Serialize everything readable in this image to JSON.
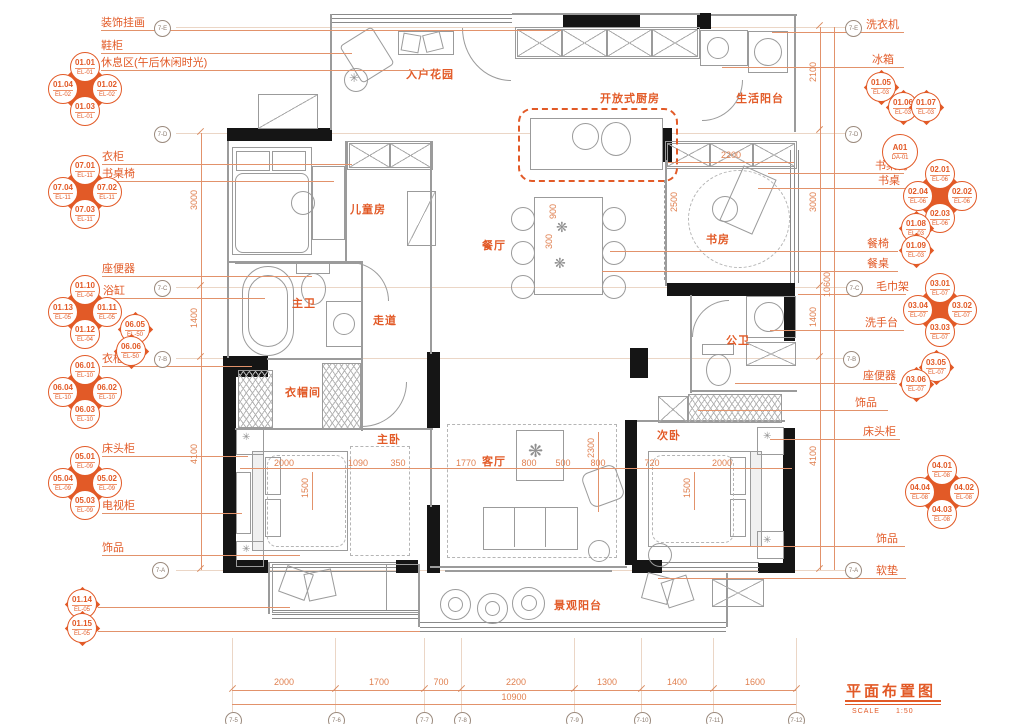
{
  "title_block": {
    "title": "平面布置图",
    "scale_label": "SCALE",
    "scale_value": "1:50"
  },
  "colors": {
    "accent": "#E25A27",
    "leader": "#E2926B",
    "wall": "#151515",
    "line": "#9B9B9B"
  },
  "rooms": {
    "entry_garden": "入户花园",
    "open_kitchen": "开放式厨房",
    "service_balcony": "生活阳台",
    "kids_room": "儿童房",
    "dining": "餐厅",
    "study": "书房",
    "master_bath": "主卫",
    "corridor": "走道",
    "guest_bath": "公卫",
    "cloakroom": "衣帽间",
    "master_bedroom": "主卧",
    "living": "客厅",
    "second_bedroom": "次卧",
    "view_balcony": "景观阳台"
  },
  "annotations": {
    "left": [
      "装饰挂画",
      "鞋柜",
      "休息区(午后休闲时光)",
      "衣柜",
      "书桌椅",
      "座便器",
      "浴缸",
      "衣柜",
      "床头柜",
      "电视柜",
      "饰品"
    ],
    "right": [
      "洗衣机",
      "冰箱",
      "书桌椅",
      "书桌",
      "餐椅",
      "餐桌",
      "毛巾架",
      "洗手台",
      "座便器",
      "饰品",
      "床头柜",
      "饰品",
      "软垫"
    ]
  },
  "markers": {
    "q01": {
      "top": {
        "code": "01.01",
        "sub": "EL-01"
      },
      "left": {
        "code": "01.04",
        "sub": "EL-02"
      },
      "right": {
        "code": "01.02",
        "sub": "EL-02"
      },
      "bottom": {
        "code": "01.03",
        "sub": "EL-01"
      }
    },
    "q07": {
      "top": {
        "code": "07.01",
        "sub": "EL-11"
      },
      "left": {
        "code": "07.04",
        "sub": "EL-11"
      },
      "right": {
        "code": "07.02",
        "sub": "EL-11"
      },
      "bottom": {
        "code": "07.03",
        "sub": "EL-11"
      }
    },
    "q10": {
      "top": {
        "code": "01.10",
        "sub": "EL-04"
      },
      "left": {
        "code": "01.13",
        "sub": "EL-05"
      },
      "right": {
        "code": "01.11",
        "sub": "EL-05"
      },
      "bottom": {
        "code": "01.12",
        "sub": "EL-04"
      }
    },
    "q06": {
      "top": {
        "code": "06.01",
        "sub": "EL-10"
      },
      "left": {
        "code": "06.04",
        "sub": "EL-10"
      },
      "right": {
        "code": "06.02",
        "sub": "EL-10"
      },
      "bottom": {
        "code": "06.03",
        "sub": "EL-10"
      }
    },
    "q05": {
      "top": {
        "code": "05.01",
        "sub": "EL-09"
      },
      "left": {
        "code": "05.04",
        "sub": "EL-09"
      },
      "right": {
        "code": "05.02",
        "sub": "EL-09"
      },
      "bottom": {
        "code": "05.03",
        "sub": "EL-09"
      }
    },
    "q02": {
      "top": {
        "code": "02.01",
        "sub": "EL-06"
      },
      "left": {
        "code": "02.04",
        "sub": "EL-06"
      },
      "right": {
        "code": "02.02",
        "sub": "EL-06"
      },
      "bottom": {
        "code": "02.03",
        "sub": "EL-06"
      }
    },
    "q03": {
      "top": {
        "code": "03.01",
        "sub": "EL-07"
      },
      "left": {
        "code": "03.04",
        "sub": "EL-07"
      },
      "right": {
        "code": "03.02",
        "sub": "EL-07"
      },
      "bottom": {
        "code": "03.03",
        "sub": "EL-07"
      }
    },
    "q04": {
      "top": {
        "code": "04.01",
        "sub": "EL-08"
      },
      "left": {
        "code": "04.04",
        "sub": "EL-08"
      },
      "right": {
        "code": "04.02",
        "sub": "EL-08"
      },
      "bottom": {
        "code": "04.03",
        "sub": "EL-08"
      }
    },
    "s0605": {
      "code": "06.05",
      "sub": "EL-50"
    },
    "s0606": {
      "code": "06.06",
      "sub": "EL-50"
    },
    "s0105": {
      "code": "01.05",
      "sub": "EL-03"
    },
    "s0106": {
      "code": "01.06",
      "sub": "EL-03"
    },
    "s0107": {
      "code": "01.07",
      "sub": "EL-03"
    },
    "s0108": {
      "code": "01.08",
      "sub": "EL-03"
    },
    "s0109": {
      "code": "01.09",
      "sub": "EL-03"
    },
    "s0305": {
      "code": "03.05",
      "sub": "EL-07"
    },
    "s0306": {
      "code": "03.06",
      "sub": "EL-07"
    },
    "s0114": {
      "code": "01.14",
      "sub": "EL-05"
    },
    "s0115": {
      "code": "01.15",
      "sub": "EL-05"
    },
    "a01": {
      "code": "A01",
      "sub": "DA-01"
    }
  },
  "grid": {
    "left": [
      "7-E",
      "7-D",
      "7-C",
      "7-B",
      "7-A"
    ],
    "right": [
      "7-E",
      "7-D",
      "7-C",
      "7-B",
      "7-A"
    ],
    "bottom": [
      "7-5",
      "7-6",
      "7-7",
      "7-8",
      "7-9",
      "7-10",
      "7-11",
      "7-12"
    ]
  },
  "dims": {
    "bottom": [
      "2000",
      "1700",
      "700",
      "2200",
      "1300",
      "1400",
      "1600"
    ],
    "bottom_total": "10900",
    "left": [
      "3000",
      "1400",
      "4100"
    ],
    "right": [
      "2100",
      "3000",
      "1400",
      "4100"
    ],
    "right_total": "10600",
    "top_balcony": "2200",
    "study_depth": "2500",
    "dining_w": "900",
    "dining_gap": "300",
    "master": [
      "2000",
      "1090",
      "350"
    ],
    "master_h": "1500",
    "living": [
      "1770",
      "800",
      "500",
      "800"
    ],
    "living_h": "2300",
    "second": [
      "720",
      "2000"
    ],
    "second_h": "1500"
  }
}
